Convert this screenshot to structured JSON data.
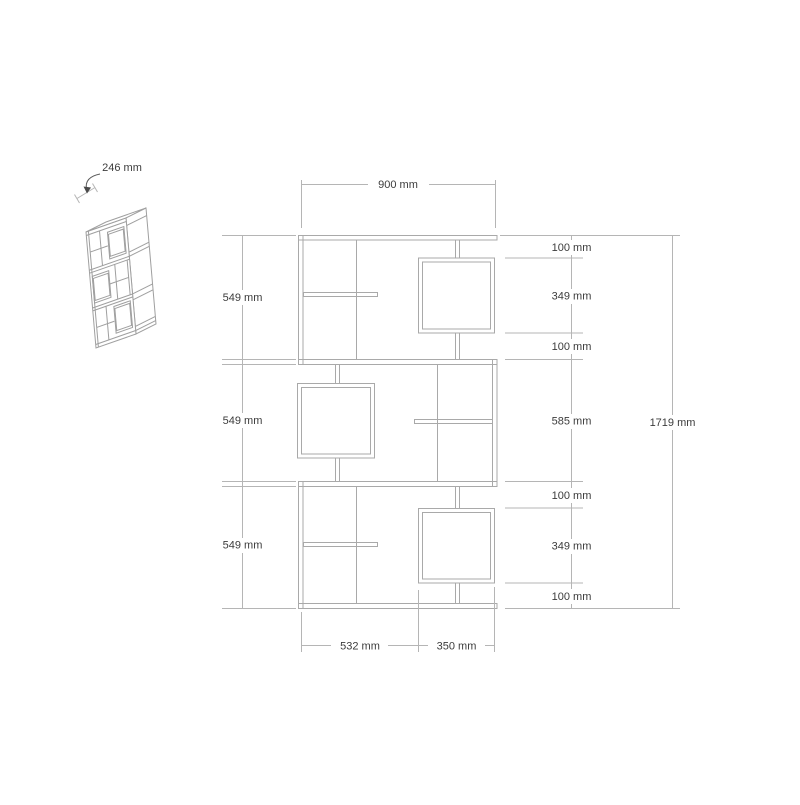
{
  "drawing": {
    "colors": {
      "line": "#a9a9a9",
      "dimension_line": "#b5b5b5",
      "text": "#3c3c3c",
      "background": "#ffffff"
    },
    "iso_view": {
      "depth_label": "246 mm"
    },
    "front_view": {
      "width_label": "900 mm",
      "total_height_label": "1719 mm",
      "left_section_heights": [
        "549 mm",
        "549 mm",
        "549 mm"
      ],
      "right_segment_heights": [
        "100 mm",
        "349 mm",
        "100 mm",
        "585 mm",
        "100 mm",
        "349 mm",
        "100 mm"
      ],
      "bottom_segment_widths": [
        "532 mm",
        "350 mm"
      ]
    }
  }
}
